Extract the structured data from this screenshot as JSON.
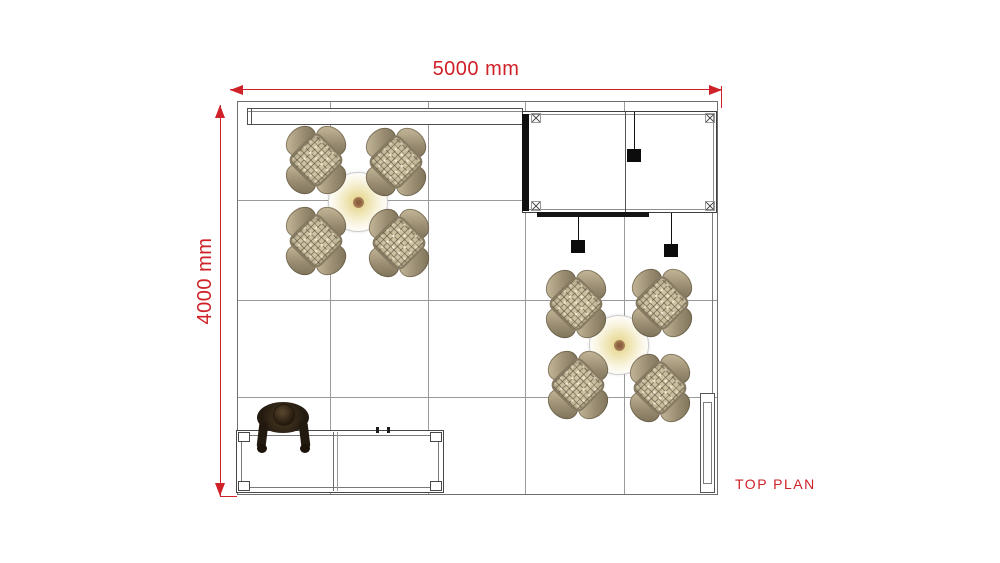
{
  "view": {
    "label": "TOP PLAN"
  },
  "dimensions": {
    "horizontal_label": "5000 mm",
    "vertical_label": "4000 mm"
  },
  "colors": {
    "accent_red": "#cf2127",
    "drawing_line": "#4f4f4f",
    "grid_line": "#9a9a9a",
    "wicker_seat": "#cfc3a3",
    "table_glow": "#efe5b4",
    "table_center_dot": "#8a5f3f"
  },
  "plan": {
    "grid_columns": 5,
    "grid_rows": 4,
    "seating_clusters": [
      {
        "id": "cluster-top-left",
        "chairs": 4,
        "table": "round table with ceiling light"
      },
      {
        "id": "cluster-bottom-right",
        "chairs": 4,
        "table": "round table with ceiling light"
      }
    ],
    "spotlight_count": 3,
    "elements": [
      "header band",
      "canopy frame with spotlights",
      "reception counter",
      "person at counter",
      "side wall panel"
    ]
  }
}
